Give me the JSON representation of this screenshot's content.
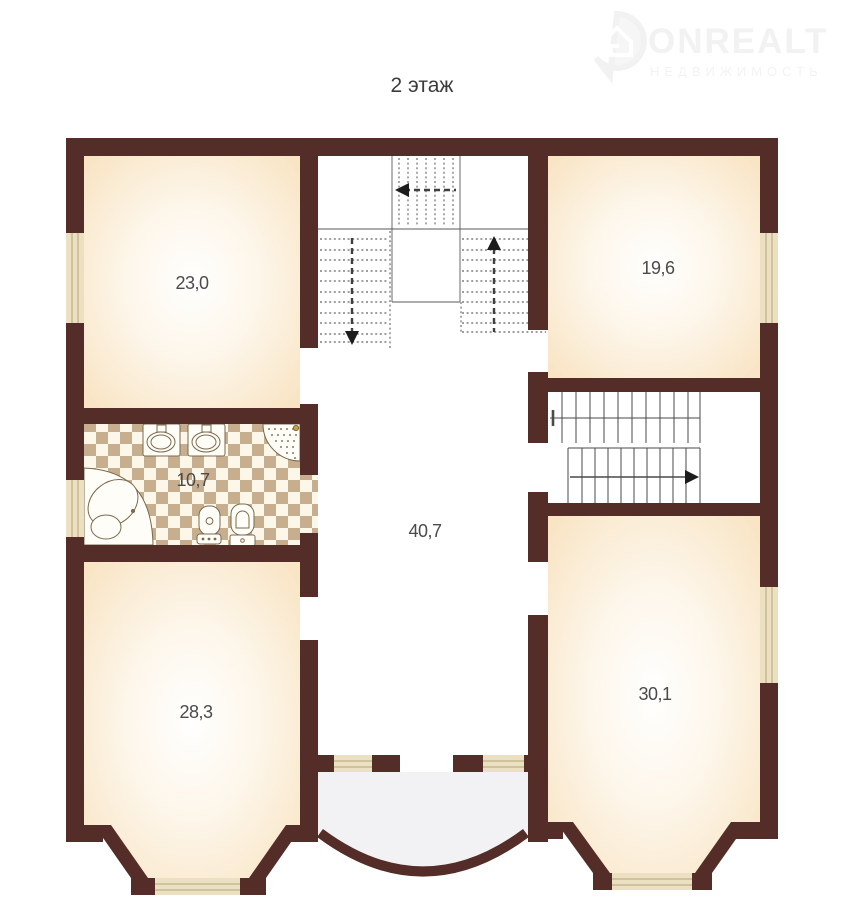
{
  "page": {
    "title": "2 этаж"
  },
  "logo": {
    "brand": "ONREALT",
    "tagline": "НЕДВИЖИМОСТЬ",
    "pin_icon": "location-pin-with-house-icon",
    "color": "#f2f2f2"
  },
  "plan": {
    "colors": {
      "wall": "#542d28",
      "room_glow_center": "#ffffff",
      "room_glow_edge": "#f9e4c4",
      "window_fill": "#ece0c2",
      "window_line": "#b3a478",
      "tile_tan": "#c6ae8e",
      "tile_light": "#fdf7ea",
      "balcony_fill": "#f2f2f5",
      "stair_line": "#3f3f3f"
    },
    "rooms": [
      {
        "id": "room-top-left",
        "area": "23,0"
      },
      {
        "id": "room-top-right",
        "area": "19,6"
      },
      {
        "id": "bathroom",
        "area": "10,7"
      },
      {
        "id": "hall",
        "area": "40,7"
      },
      {
        "id": "room-bottom-left",
        "area": "28,3"
      },
      {
        "id": "room-bottom-right",
        "area": "30,1"
      }
    ],
    "fixtures": [
      "corner-bathtub-icon",
      "sink-icon",
      "sink-icon",
      "shower-cabin-icon",
      "bidet-icon",
      "toilet-icon"
    ],
    "stairs": [
      {
        "id": "upper-u-stair",
        "style": "dashed",
        "arrows": [
          "left",
          "down",
          "up"
        ]
      },
      {
        "id": "right-stair",
        "style": "solid",
        "arrows": [
          "right"
        ]
      }
    ],
    "features": [
      "bay-window-left",
      "bay-window-right",
      "arc-balcony",
      "windows",
      "door-openings"
    ]
  }
}
